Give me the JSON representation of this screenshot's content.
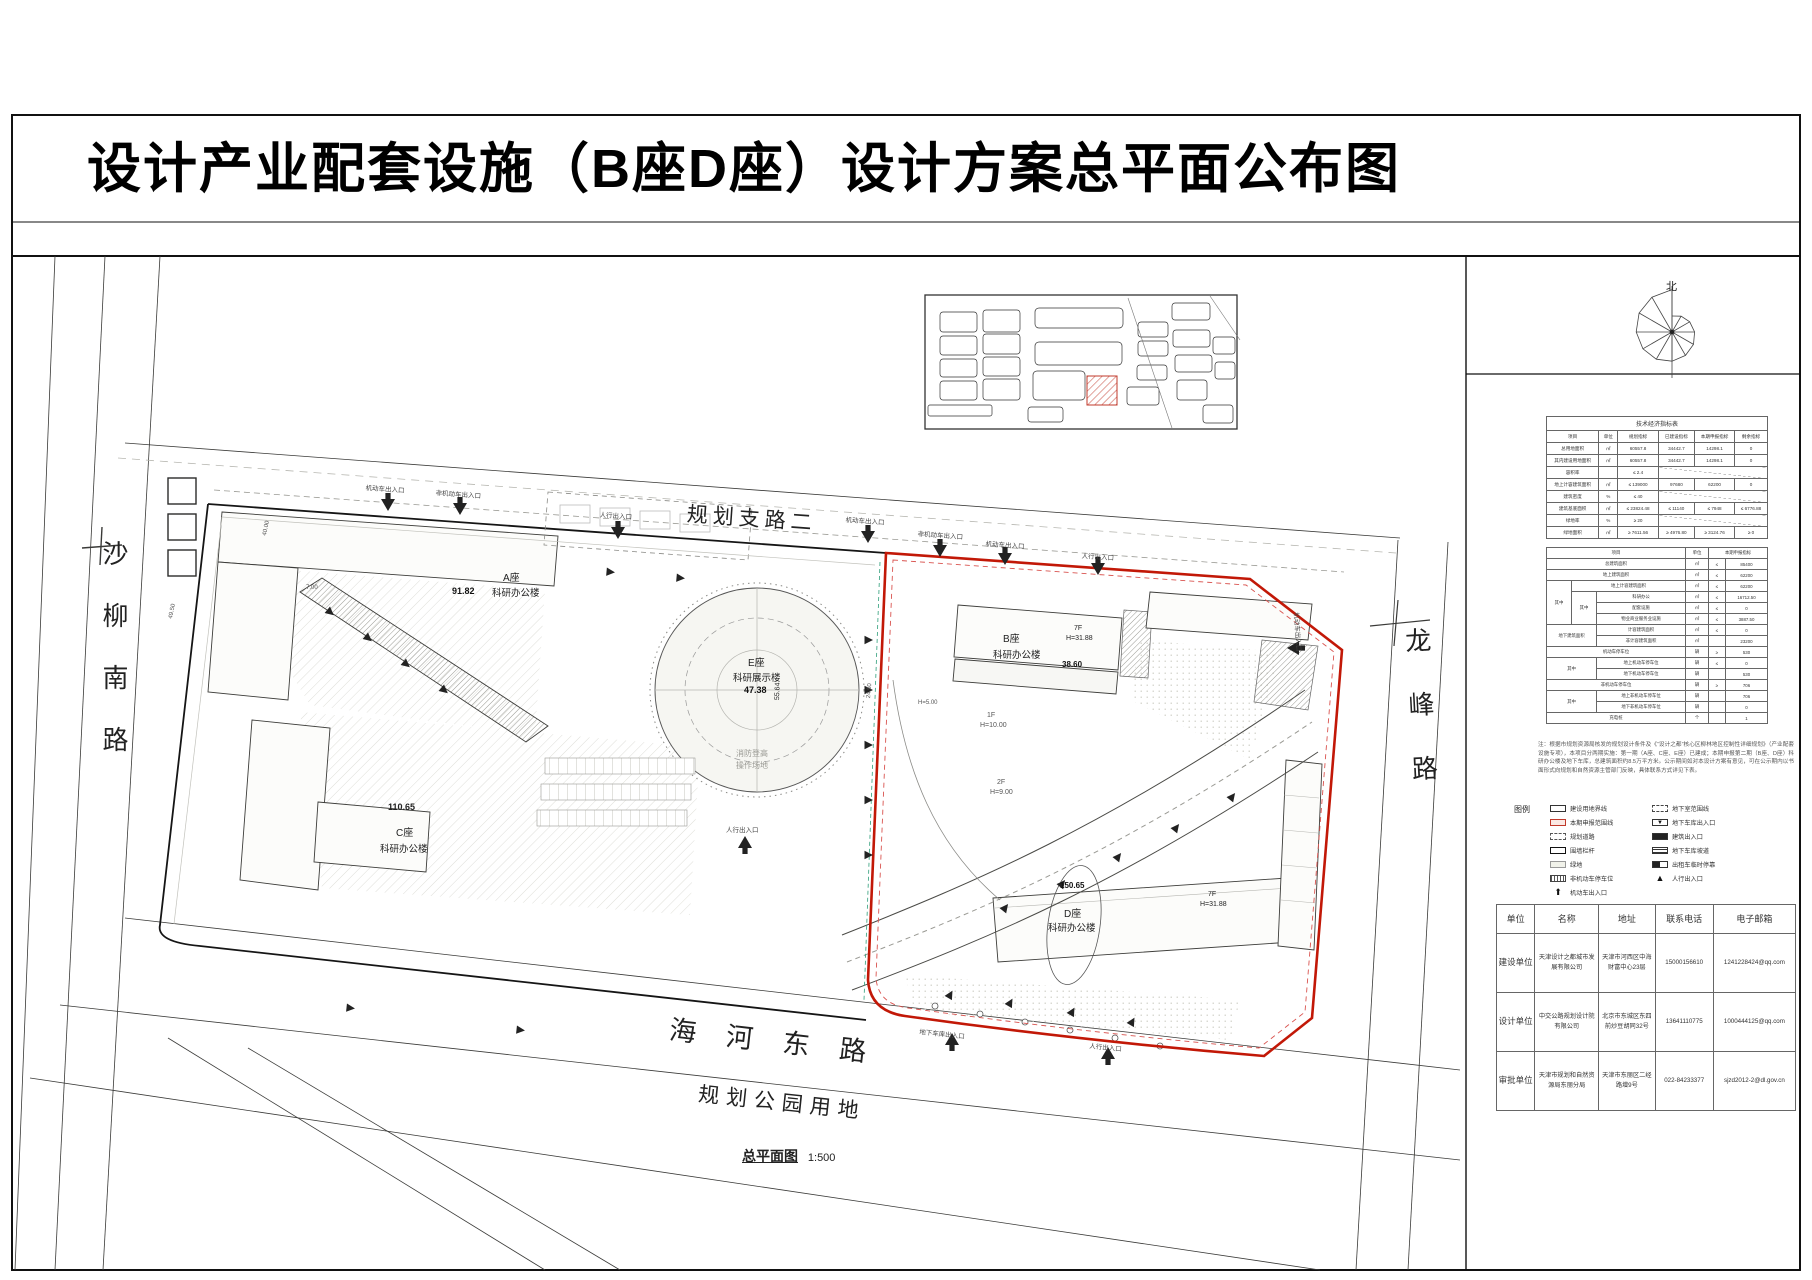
{
  "title": "设计产业配套设施（B座D座）设计方案总平面公布图",
  "compass": {
    "north": "北"
  },
  "map": {
    "roads": {
      "left": "沙柳南路",
      "top": "规划支路二",
      "right": "龙峰路",
      "bottom": "海河东路",
      "park": "规划公园用地"
    },
    "caption": {
      "name": "总平面图",
      "scale": "1:500"
    },
    "buildings": {
      "a": {
        "name": "A座",
        "type": "科研办公楼",
        "dim": "91.82"
      },
      "b": {
        "name": "B座",
        "type": "科研办公楼",
        "floors": "7F",
        "height": "H=31.88",
        "dim": "38.60"
      },
      "c": {
        "name": "C座",
        "type": "科研办公楼",
        "dim": "110.65"
      },
      "d": {
        "name": "D座",
        "type": "科研办公楼",
        "floors": "7F",
        "height": "H=31.88",
        "dim": "150.65"
      },
      "e": {
        "name": "E座",
        "type": "科研展示楼",
        "dim": "47.38",
        "dim2": "55.64",
        "fire1": "消防登高",
        "fire2": "操作场地"
      }
    },
    "annotations": {
      "f1": "1F",
      "f1h": "H=10.00",
      "f2": "2F",
      "f2h": "H=9.00",
      "h5": "H=5.00",
      "d245": "24.50",
      "d40": "40.00",
      "d495": "49.50",
      "d70": "7.00"
    },
    "entrances": {
      "veh": "机动车出入口",
      "nonveh": "非机动车出入口",
      "ped": "人行出入口",
      "garage": "地下车库出入口"
    }
  },
  "tech_table": {
    "title": "技术经济指标表",
    "headers": [
      "项目",
      "单位",
      "规划指标",
      "已建设指标",
      "本期申报指标",
      "剩余指标"
    ],
    "rows": [
      [
        "总用地面积",
        "㎡",
        "60557.8",
        "34442.7",
        "14298.1",
        "0"
      ],
      [
        "其内建设用地面积",
        "㎡",
        "60557.8",
        "34442.7",
        "14298.1",
        "0"
      ],
      [
        "容积率",
        "",
        "≤ 2.4",
        "",
        "",
        ""
      ],
      [
        "地上计容建筑面积",
        "㎡",
        "≤ 139000",
        "97680",
        "62200",
        "0"
      ],
      [
        "建筑密度",
        "%",
        "≤ 40",
        "",
        "",
        ""
      ],
      [
        "建筑基底面积",
        "㎡",
        "≤ 23824.48",
        "≤ 11140",
        "≤ 7948",
        "≤ 6776.88"
      ],
      [
        "绿地率",
        "%",
        "≥ 20",
        "",
        "",
        ""
      ],
      [
        "绿地面积",
        "㎡",
        "≥ 7611.56",
        "≥ 4976.80",
        "≥ 3124.76",
        "≥ 0"
      ]
    ]
  },
  "detail_table": {
    "headers": [
      "项目",
      "单位",
      "本期申报指标"
    ],
    "rows": [
      {
        "name": "总建筑面积",
        "unit": "㎡",
        "sign": "≤",
        "val": "85400"
      },
      {
        "name": "地上建筑面积",
        "unit": "㎡",
        "sign": "≤",
        "val": "62200"
      },
      {
        "g": "其中",
        "name": "地上计容建筑面积",
        "unit": "㎡",
        "sign": "≤",
        "val": "62200"
      },
      {
        "g2": "其中",
        "name": "科研办公",
        "unit": "㎡",
        "sign": "≤",
        "val": "16712.50"
      },
      {
        "name": "配套设施",
        "unit": "㎡",
        "sign": "≤",
        "val": "0"
      },
      {
        "name": "物业商业服务业设施",
        "unit": "㎡",
        "sign": "≤",
        "val": "3887.50"
      },
      {
        "g": "地下建筑面积",
        "name": "计容建筑面积",
        "unit": "㎡",
        "sign": "≤",
        "val": "0"
      },
      {
        "name": "非计容建筑面积",
        "unit": "㎡",
        "sign": "",
        "val": "23200"
      },
      {
        "name": "机动车停车位",
        "unit": "辆",
        "sign": "≥",
        "val": "530"
      },
      {
        "g": "其中",
        "name": "地上机动车停车位",
        "unit": "辆",
        "sign": "≤",
        "val": "0"
      },
      {
        "name": "地下机动车停车位",
        "unit": "辆",
        "sign": "",
        "val": "530"
      },
      {
        "name": "非机动车停车位",
        "unit": "辆",
        "sign": "≥",
        "val": "706"
      },
      {
        "g": "其中",
        "name": "地上非机动车停车位",
        "unit": "辆",
        "sign": "",
        "val": "706"
      },
      {
        "name": "地下非机动车停车位",
        "unit": "辆",
        "sign": "",
        "val": "0"
      },
      {
        "name": "充电桩",
        "unit": "个",
        "sign": "",
        "val": "1"
      }
    ]
  },
  "note": "注：根据市规划资源局核发的规划设计条件及《“设计之都”核心区柳林地区控制性详细规划》（产业配套设施专项），本项目分两期实施：第一期（A座、C座、E座）已建成；本期申报第二期（B座、D座）科研办公楼及地下车库，总建筑面积约8.5万平方米。公示期间如对本设计方案有意见，可在公示期内以书面形式向规划和自然资源主管部门反映，具体联系方式详见下表。",
  "legend": {
    "title": "图例",
    "left": [
      {
        "label": "建设用地界线"
      },
      {
        "label": "本期申报范围线"
      },
      {
        "label": "规划道路"
      },
      {
        "label": "围墙栏杆"
      },
      {
        "label": "绿地"
      },
      {
        "label": "非机动车停车位"
      },
      {
        "label": "机动车出入口"
      }
    ],
    "right": [
      {
        "label": "地下室范围线"
      },
      {
        "label": "地下车库出入口"
      },
      {
        "label": "建筑出入口"
      },
      {
        "label": "地下车库坡道"
      },
      {
        "label": "出租车临时停靠"
      },
      {
        "label": "人行出入口"
      }
    ]
  },
  "contact_table": {
    "headers": [
      "单位",
      "名称",
      "地址",
      "联系电话",
      "电子邮箱"
    ],
    "rows": [
      {
        "unit": "建设单位",
        "name": "天津设计之都城市发展有限公司",
        "addr": "天津市河西区中海财富中心23层",
        "tel": "15000156610",
        "mail": "1241228424@qq.com"
      },
      {
        "unit": "设计单位",
        "name": "中交公路规划设计院有限公司",
        "addr": "北京市东城区东四前炒豆胡同32号",
        "tel": "13641110775",
        "mail": "1000444125@qq.com"
      },
      {
        "unit": "审批单位",
        "name": "天津市规划和自然资源局东丽分局",
        "addr": "天津市东丽区二经路增9号",
        "tel": "022-84233377",
        "mail": "sjzd2012-2@dl.gov.cn"
      }
    ]
  }
}
